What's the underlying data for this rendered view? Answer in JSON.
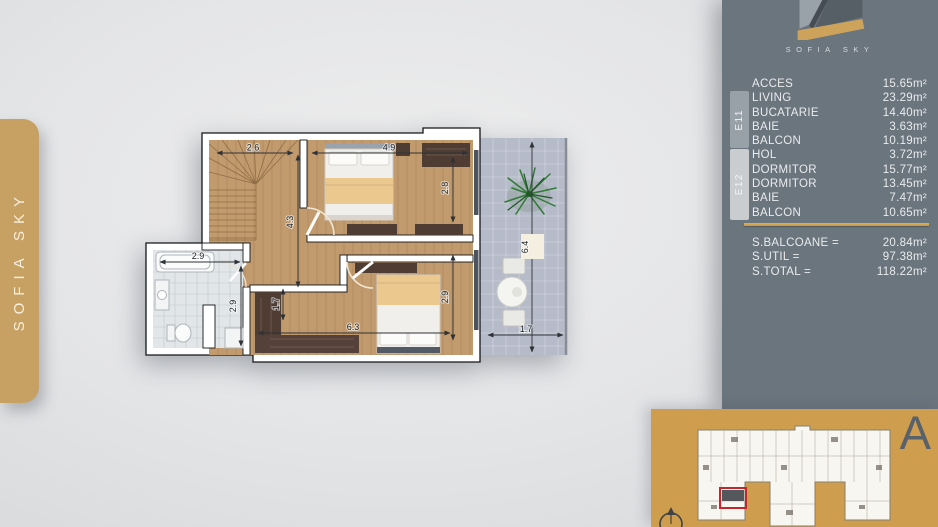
{
  "sidebar": {
    "brand": "SOFIA SKY"
  },
  "panel": {
    "logo_text": "SOFIA SKY",
    "groups": {
      "e11": "E11",
      "e12": "E12"
    },
    "rooms": [
      {
        "label": "ACCES",
        "value": "15.65m²"
      },
      {
        "label": "LIVING",
        "value": "23.29m²"
      },
      {
        "label": "BUCATARIE",
        "value": "14.40m²"
      },
      {
        "label": "BAIE",
        "value": "3.63m²"
      },
      {
        "label": "BALCON",
        "value": "10.19m²"
      },
      {
        "label": "HOL",
        "value": "3.72m²"
      },
      {
        "label": "DORMITOR",
        "value": "15.77m²"
      },
      {
        "label": "DORMITOR",
        "value": "13.45m²"
      },
      {
        "label": "BAIE",
        "value": "7.47m²"
      },
      {
        "label": "BALCON",
        "value": "10.65m²"
      }
    ],
    "summary": [
      {
        "label": "S.BALCOANE =",
        "value": "20.84m²"
      },
      {
        "label": "S.UTIL =",
        "value": "97.38m²"
      },
      {
        "label": "S.TOTAL =",
        "value": "118.22m²"
      }
    ]
  },
  "floorplan": {
    "dims": {
      "stair_w": "2.6",
      "stair_h": "4.3",
      "bed1_w": "4.9",
      "bed1_h": "2.8",
      "bath_w": "2.9",
      "bath_h": "2.9",
      "closet": "1.7",
      "bed2_w": "6.3",
      "bed2_h": "2.9",
      "balcony_l": "6.4",
      "balcony_w": "1.7"
    }
  },
  "site": {
    "block_letter": "A"
  },
  "colors": {
    "gold": "#C7A163",
    "panel_gray": "#6B757E",
    "site_gold": "#CE9D4E",
    "highlight_red": "#C1272D"
  }
}
